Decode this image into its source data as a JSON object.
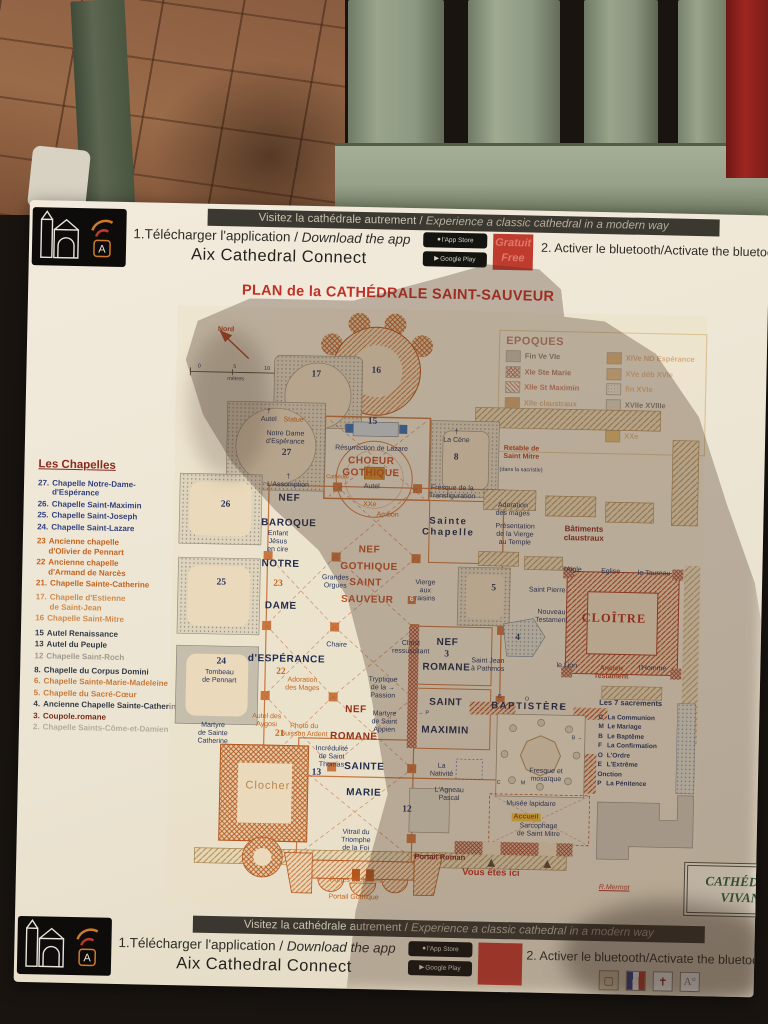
{
  "banners": {
    "strip_fr": "Visitez la cathédrale autrement /",
    "strip_en": " Experience a classic cathedral in a modern way",
    "step1_fr": "1.Télécharger l'application / ",
    "step1_en": "Download the app",
    "app_name": "Aix Cathedral Connect",
    "appstore_label": "l'App Store",
    "googleplay_label": "Google Play",
    "free_fr": "Gratuit",
    "free_en": "Free",
    "step2": "2. Activer le bluetooth/Activate the bluetooth"
  },
  "title": "PLAN de la CATHÉDRALE SAINT-SAUVEUR",
  "legend": {
    "title": "EPOQUES",
    "left": [
      {
        "label": "Fin Ve VIe",
        "sw": "solid",
        "color": "#a9a294",
        "text": "#3a3430"
      },
      {
        "label": "XIe Ste Marie",
        "sw": "cross",
        "color": "#8a2a1e",
        "text": "#8a2a1e"
      },
      {
        "label": "XIIe St Maximin",
        "sw": "hatch",
        "color": "#c0392b",
        "text": "#b5301f"
      },
      {
        "label": "XIIe claustraux",
        "sw": "solid",
        "color": "#c07a30",
        "text": "#c4824a"
      },
      {
        "label": "fin XIIIe XIVe Gothique",
        "sw": "solid",
        "color": "#d08040",
        "text": "#c4641f"
      }
    ],
    "right": [
      {
        "label": "XIVe ND Espérance",
        "sw": "solid",
        "color": "#d08a3a",
        "text": "#c4824a"
      },
      {
        "label": "XVe déb XVIe",
        "sw": "solid",
        "color": "#d99b55",
        "text": "#cc8f55"
      },
      {
        "label": "fin XVIe",
        "sw": "dots",
        "color": "#9a9488",
        "text": "#cc8f55"
      },
      {
        "label": "XVIIe XVIIIe",
        "sw": "solid",
        "color": "#ccc5b4",
        "text": "#3a3430"
      },
      {
        "label": "XIXe",
        "sw": "solid",
        "color": "#b9b2a2",
        "text": "#3a3430"
      },
      {
        "label": "XXe",
        "sw": "solid",
        "color": "#d29a28",
        "text": "#cc8f55"
      }
    ]
  },
  "chapelles": {
    "title": "Les Chapelles",
    "items": [
      {
        "num": "27.",
        "name": "Chapelle Notre-Dame-\nd'Espérance",
        "color": "#33427c"
      },
      {
        "num": "26.",
        "name": "Chapelle Saint-Maximin",
        "color": "#33427c"
      },
      {
        "num": "25.",
        "name": "Chapelle Saint-Joseph",
        "color": "#33427c"
      },
      {
        "num": "24.",
        "name": "Chapelle Saint-Lazare",
        "color": "#33427c"
      },
      {
        "num": "23",
        "name": "Ancienne chapelle\nd'Olivier de Pennart",
        "color": "#c4641f"
      },
      {
        "num": "22",
        "name": "Ancienne chapelle\nd'Armand de Narcès",
        "color": "#c4641f"
      },
      {
        "num": "21.",
        "name": "Chapelle Sainte-Catherine",
        "color": "#c4641f"
      },
      {
        "num": "17.",
        "name": "Chapelle d'Estienne\nde Saint-Jean",
        "color": "#cf8b4e"
      },
      {
        "num": "16",
        "name": "Chapelle Saint-Mitre",
        "color": "#cf8b4e"
      },
      {
        "num": "15",
        "name": "Autel Renaissance",
        "color": "#333a45"
      },
      {
        "num": "13",
        "name": "Autel du Peuple",
        "color": "#333a45"
      },
      {
        "num": "12",
        "name": "Chapelle Saint-Roch",
        "color": "#a09a8c"
      },
      {
        "num": "8.",
        "name": "Chapelle du Corpus Domini",
        "color": "#333a45"
      },
      {
        "num": "6.",
        "name": "Chapelle Sainte-Marie-Madeleine",
        "color": "#c87a3a"
      },
      {
        "num": "5.",
        "name": "Chapelle du Sacré-Cœur",
        "color": "#c87a3a"
      },
      {
        "num": "4.",
        "name": "Ancienne Chapelle Sainte-Catherine",
        "color": "#333a45"
      },
      {
        "num": "3.",
        "name": "Coupole.romane",
        "color": "#7a2a1a"
      },
      {
        "num": "2.",
        "name": "Chapelle Saints-Côme-et-Damien",
        "color": "#b3ac9e"
      }
    ]
  },
  "map_labels": [
    {
      "t": "Nord",
      "x": 9.2,
      "y": 4,
      "c": "sr"
    },
    {
      "t": "0",
      "x": 4.3,
      "y": 10.2,
      "c": "tiny"
    },
    {
      "t": "5",
      "x": 11,
      "y": 10.2,
      "c": "tiny"
    },
    {
      "t": "10",
      "x": 17.1,
      "y": 10.3,
      "c": "tiny"
    },
    {
      "t": "mètres",
      "x": 11.2,
      "y": 12.2,
      "c": "tiny"
    },
    {
      "t": "17",
      "x": 26.4,
      "y": 11.1,
      "c": "nb"
    },
    {
      "t": "16",
      "x": 37.7,
      "y": 10.3,
      "c": "nb"
    },
    {
      "t": "15",
      "x": 37.2,
      "y": 18.9,
      "c": "nb"
    },
    {
      "t": "†\nAutel",
      "x": 17.6,
      "y": 18.2,
      "c": "sn"
    },
    {
      "t": "Statue",
      "x": 22.3,
      "y": 18.9,
      "c": "so"
    },
    {
      "t": "Notre Dame\nd'Espérance",
      "x": 20.8,
      "y": 21.8,
      "c": "sn"
    },
    {
      "t": "27",
      "x": 21.1,
      "y": 24.4,
      "c": "nb"
    },
    {
      "t": "Résurrection de Lazare",
      "x": 37.1,
      "y": 23.3,
      "c": "sn"
    },
    {
      "t": "CHOEUR\nGOTHIQUE",
      "x": 37.1,
      "y": 26.4,
      "c": "r1"
    },
    {
      "t": "†\nLa Cène",
      "x": 53.1,
      "y": 21,
      "c": "sn"
    },
    {
      "t": "8",
      "x": 53.1,
      "y": 24.5,
      "c": "nb"
    },
    {
      "t": "Retable de\nSaint Mitre",
      "x": 65.4,
      "y": 23.5,
      "c": "sr"
    },
    {
      "t": "(dans la sacristie)",
      "x": 65.4,
      "y": 26.4,
      "c": "tiny"
    },
    {
      "t": "26",
      "x": 9.8,
      "y": 33.1,
      "c": "nb"
    },
    {
      "t": "†\nL'Assomption",
      "x": 21.5,
      "y": 29,
      "c": "sn"
    },
    {
      "t": "NEF",
      "x": 21.8,
      "y": 31.9,
      "c": "n1"
    },
    {
      "t": "BAROQUE",
      "x": 21.8,
      "y": 36,
      "c": "n1"
    },
    {
      "t": "Autel",
      "x": 37.3,
      "y": 29.6,
      "c": "sn"
    },
    {
      "t": "XXe",
      "x": 37,
      "y": 32.6,
      "c": "so"
    },
    {
      "t": "Cathèdre",
      "x": 30.8,
      "y": 28.2,
      "c": "tiny-o"
    },
    {
      "t": "Ambon",
      "x": 40.4,
      "y": 34.4,
      "c": "so"
    },
    {
      "t": "Fresque de la\nTransfiguration",
      "x": 52.5,
      "y": 30.4,
      "c": "sn"
    },
    {
      "t": "Sainte\nChapelle",
      "x": 51.9,
      "y": 36.1,
      "c": "n2"
    },
    {
      "t": "Adoration\ndes mages",
      "x": 64,
      "y": 33,
      "c": "sn"
    },
    {
      "t": "Présentation\nde la Vierge\nau Temple",
      "x": 64.5,
      "y": 37.2,
      "c": "sn"
    },
    {
      "t": "Bâtiments\nclaustraux",
      "x": 77.5,
      "y": 36.7,
      "c": "r2b"
    },
    {
      "t": "Enfant\nJésus\nen cire",
      "x": 19.8,
      "y": 39.2,
      "c": "sn"
    },
    {
      "t": "NOTRE",
      "x": 20.4,
      "y": 42.8,
      "c": "n1"
    },
    {
      "t": "25",
      "x": 9.3,
      "y": 46.1,
      "c": "nb"
    },
    {
      "t": "23",
      "x": 20,
      "y": 46.1,
      "c": "no"
    },
    {
      "t": "DAME",
      "x": 20.6,
      "y": 49.8,
      "c": "n1"
    },
    {
      "t": "NEF",
      "x": 37.1,
      "y": 40.1,
      "c": "r1"
    },
    {
      "t": "GOTHIQUE",
      "x": 37.1,
      "y": 43,
      "c": "r1"
    },
    {
      "t": "SAINT",
      "x": 36.5,
      "y": 45.6,
      "c": "r1"
    },
    {
      "t": "SAUVEUR",
      "x": 36.9,
      "y": 48.5,
      "c": "r1"
    },
    {
      "t": "Grandes\nOrgues",
      "x": 30.8,
      "y": 45.6,
      "c": "sn"
    },
    {
      "t": "Vierge\naux\nraisins",
      "x": 47.8,
      "y": 46.8,
      "c": "sn"
    },
    {
      "t": "6",
      "x": 45.3,
      "y": 48.3,
      "c": "n6"
    },
    {
      "t": "5",
      "x": 60.7,
      "y": 46.1,
      "c": "nb"
    },
    {
      "t": "Saint Pierre",
      "x": 70.8,
      "y": 46.4,
      "c": "sn"
    },
    {
      "t": "l'Aigle",
      "x": 75.5,
      "y": 42.9,
      "c": "sn"
    },
    {
      "t": "Eglise",
      "x": 82.7,
      "y": 43,
      "c": "sn"
    },
    {
      "t": "le Taureau",
      "x": 90.9,
      "y": 43.1,
      "c": "sn"
    },
    {
      "t": "Nouveau\nTestament",
      "x": 71.7,
      "y": 50.6,
      "c": "sn"
    },
    {
      "t": "CLOÎTRE",
      "x": 83.5,
      "y": 50.6,
      "c": "r3"
    },
    {
      "t": "le Lion",
      "x": 74.8,
      "y": 58.9,
      "c": "sn"
    },
    {
      "t": "Ancien\nTestament",
      "x": 83.2,
      "y": 59.8,
      "c": "sr"
    },
    {
      "t": "l'Homme",
      "x": 91,
      "y": 59,
      "c": "sn"
    },
    {
      "t": "Chaire",
      "x": 31.3,
      "y": 56.2,
      "c": "sn"
    },
    {
      "t": "Christ\nressuscitant",
      "x": 45.3,
      "y": 56.3,
      "c": "sn"
    },
    {
      "t": "NEF",
      "x": 52.2,
      "y": 55.3,
      "c": "n1"
    },
    {
      "t": "3",
      "x": 52.1,
      "y": 57.3,
      "c": "nb"
    },
    {
      "t": "ROMANE",
      "x": 52.1,
      "y": 59.5,
      "c": "n1"
    },
    {
      "t": "Saint Jean\nà Pathmos",
      "x": 59.9,
      "y": 59,
      "c": "sn"
    },
    {
      "t": "24",
      "x": 9.6,
      "y": 59.3,
      "c": "nb"
    },
    {
      "t": "Tombeau\nde Pennart",
      "x": 9.3,
      "y": 61.8,
      "c": "sn"
    },
    {
      "t": "d'ESPÉRANCE",
      "x": 21.9,
      "y": 58.6,
      "c": "n1"
    },
    {
      "t": "22",
      "x": 20.9,
      "y": 60.9,
      "c": "no"
    },
    {
      "t": "Adoration\ndes Mages",
      "x": 25,
      "y": 62.9,
      "c": "so"
    },
    {
      "t": "Tryptique\nde la →\nPassion",
      "x": 40.2,
      "y": 63.2,
      "c": "sn"
    },
    {
      "t": "SAINT",
      "x": 52.1,
      "y": 65.4,
      "c": "n1"
    },
    {
      "t": "MAXIMIN",
      "x": 52.1,
      "y": 70,
      "c": "n1"
    },
    {
      "t": "← P",
      "x": 48,
      "y": 67.2,
      "c": "tiny"
    },
    {
      "t": "4",
      "x": 65.4,
      "y": 54.4,
      "c": "nb"
    },
    {
      "t": "Les 7 sacrements",
      "x": 87,
      "y": 64.9,
      "c": "snb"
    },
    {
      "t": "NEF",
      "x": 35.2,
      "y": 66.9,
      "c": "r2"
    },
    {
      "t": "ROMANE",
      "x": 34.9,
      "y": 71.4,
      "c": "r2"
    },
    {
      "t": "Martyre\nde Saint\nAppien",
      "x": 40.6,
      "y": 68.8,
      "c": "sn"
    },
    {
      "t": "Autel des\nAygosi",
      "x": 18.4,
      "y": 69,
      "c": "so"
    },
    {
      "t": "Photo du\nBuisson Ardent",
      "x": 25.5,
      "y": 70.5,
      "c": "so"
    },
    {
      "t": "21",
      "x": 20.9,
      "y": 71.1,
      "c": "no"
    },
    {
      "t": "Martyre\nde Sainte\nCatherine",
      "x": 8.3,
      "y": 71.4,
      "c": "sn"
    },
    {
      "t": "Incrédulité\nde Saint\nThomas",
      "x": 30.8,
      "y": 74.8,
      "c": "sn"
    },
    {
      "t": "13",
      "x": 28,
      "y": 77.5,
      "c": "nb"
    },
    {
      "t": "SAINTE",
      "x": 37,
      "y": 76.4,
      "c": "n1"
    },
    {
      "t": "MARIE",
      "x": 37,
      "y": 80.7,
      "c": "n1"
    },
    {
      "t": "La\nNativité",
      "x": 51.6,
      "y": 76.6,
      "c": "sn"
    },
    {
      "t": "L'Agneau\nPascal",
      "x": 53.1,
      "y": 80.6,
      "c": "sn"
    },
    {
      "t": "12",
      "x": 45.2,
      "y": 83.4,
      "c": "nb"
    },
    {
      "t": "Clocher",
      "x": 18.9,
      "y": 79.9,
      "c": "cl"
    },
    {
      "t": "BAPTISTÈRE",
      "x": 67.9,
      "y": 65.9,
      "c": "n2"
    },
    {
      "t": "E",
      "x": 62.3,
      "y": 64.2,
      "c": "tiny"
    },
    {
      "t": "O",
      "x": 67.4,
      "y": 64.5,
      "c": "tiny"
    },
    {
      "t": "F",
      "x": 73.9,
      "y": 65.8,
      "c": "tiny"
    },
    {
      "t": "B →",
      "x": 77,
      "y": 70.8,
      "c": "tiny"
    },
    {
      "t": "C",
      "x": 62.4,
      "y": 78.5,
      "c": "tiny"
    },
    {
      "t": "M",
      "x": 67,
      "y": 78.5,
      "c": "tiny"
    },
    {
      "t": "Fresque et\nmosaïque",
      "x": 71.3,
      "y": 77.2,
      "c": "sn"
    },
    {
      "t": "Musée lapidaire",
      "x": 68.6,
      "y": 82,
      "c": "sn"
    },
    {
      "t": "Accueil",
      "x": 67.7,
      "y": 84.2,
      "c": "acc"
    },
    {
      "t": "Sarcophage\nde Saint Mitre",
      "x": 70.1,
      "y": 86.4,
      "c": "sn"
    },
    {
      "t": "Vitrail du\nTriomphe\nde la Foi",
      "x": 35.7,
      "y": 88.6,
      "c": "sn"
    },
    {
      "t": "Portail Roman",
      "x": 51.6,
      "y": 91.2,
      "c": "srb"
    },
    {
      "t": "Vous êtes ici",
      "x": 61.3,
      "y": 93.7,
      "c": "vei"
    },
    {
      "t": "Portes sculptées",
      "x": 35.8,
      "y": 95.3,
      "c": "so"
    },
    {
      "t": "Portail Gothique",
      "x": 35.5,
      "y": 98.2,
      "c": "so"
    },
    {
      "t": "R.Mermot",
      "x": 84.6,
      "y": 95.6,
      "c": "sig"
    }
  ],
  "sacrements": {
    "items": [
      {
        "k": "C",
        "v": "La Communion"
      },
      {
        "k": "M",
        "v": "Le Mariage"
      },
      {
        "k": "B",
        "v": "Le Baptême"
      },
      {
        "k": "F",
        "v": "La Confirmation"
      },
      {
        "k": "O",
        "v": "L'Ordre"
      },
      {
        "k": "E",
        "v": "L'Extrême\n      Onction"
      },
      {
        "k": "P",
        "v": "La Pénitence"
      }
    ]
  },
  "footer_box": {
    "line1": "CATHÉDRALE",
    "line2": "VIVANTE"
  },
  "colors": {
    "accent_red": "#c03024",
    "navy": "#27355e",
    "orange": "#c4641f",
    "dark_red": "#8a2a1e"
  }
}
